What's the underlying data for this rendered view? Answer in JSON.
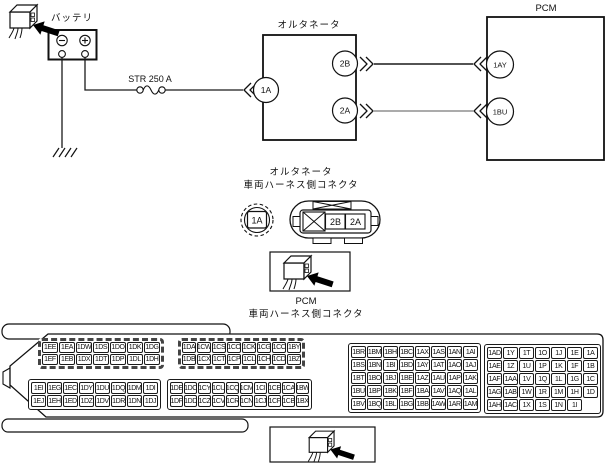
{
  "top_diagram": {
    "battery": {
      "label": "バッテリ",
      "minus_symbol": "−",
      "plus_symbol": "+"
    },
    "fuse": {
      "label": "STR 250 A"
    },
    "alternator": {
      "label": "オルタネータ",
      "pin_1a": "1A",
      "pin_2b": "2B",
      "pin_2a": "2A"
    },
    "pcm": {
      "label": "PCM",
      "pin_1ay": "1AY",
      "pin_1bu": "1BU"
    },
    "wire_colors": {
      "black_wire": "#1a1a1a",
      "gray_wire": "#8f8f8f"
    }
  },
  "alt_connector": {
    "title_line1": "オルタネータ",
    "title_line2": "車両ハーネス側コネクタ",
    "round_pin": "1A",
    "oval_pins": [
      "2B",
      "2A"
    ]
  },
  "pcm_connector": {
    "title_line1": "PCM",
    "title_line2": "車両ハーネス側コネクタ",
    "blocks": {
      "b1_top": [
        [
          "1EE",
          "1EA",
          "1DW",
          "1DS",
          "1DO",
          "1DK",
          "1DG"
        ],
        [
          "1EF",
          "1EB",
          "1DX",
          "1DT",
          "1DP",
          "1DL",
          "1DH"
        ]
      ],
      "b1_bottom": [
        [
          "1EI",
          "1EG",
          "1EC",
          "1DY",
          "1DU",
          "1DQ",
          "1DM",
          "1DI"
        ],
        [
          "1EJ",
          "1EH",
          "1ED",
          "1DZ",
          "1DV",
          "1DR",
          "1DN",
          "1DJ"
        ]
      ],
      "b2_top": [
        [
          "1DA",
          "1CW",
          "1CS",
          "1CO",
          "1CK",
          "1CG",
          "1CC",
          "1BY"
        ],
        [
          "1DB",
          "1CX",
          "1CT",
          "1CP",
          "1CL",
          "1CH",
          "1CD",
          "1BZ"
        ]
      ],
      "b2_bottom": [
        [
          "1DE",
          "1DC",
          "1CY",
          "1CU",
          "1CQ",
          "1CM",
          "1CI",
          "1CE",
          "1CA",
          "1BW"
        ],
        [
          "1DF",
          "1DD",
          "1CZ",
          "1CV",
          "1CR",
          "1CN",
          "1CJ",
          "1CF",
          "1CB",
          "1BX"
        ]
      ],
      "b3": [
        [
          "1BR",
          "1BM",
          "1BH",
          "1BC",
          "1AX",
          "1AS",
          "1AN",
          "1AI"
        ],
        [
          "1BS",
          "1BN",
          "1BI",
          "1BD",
          "1AY",
          "1AT",
          "1AO",
          "1AJ"
        ],
        [
          "1BT",
          "1BO",
          "1BJ",
          "1BE",
          "1AZ",
          "1AU",
          "1AP",
          "1AK"
        ],
        [
          "1BU",
          "1BP",
          "1BK",
          "1BF",
          "1BA",
          "1AV",
          "1AQ",
          "1AL"
        ],
        [
          "1BV",
          "1BQ",
          "1BL",
          "1BG",
          "1BB",
          "1AW",
          "1AR",
          "1AM"
        ]
      ],
      "b4": [
        [
          "1AD",
          "1Y",
          "1T",
          "1O",
          "1J",
          "1E",
          "1A"
        ],
        [
          "1AE",
          "1Z",
          "1U",
          "1P",
          "1K",
          "1F",
          "1B"
        ],
        [
          "1AF",
          "1AA",
          "1V",
          "1Q",
          "1L",
          "1G",
          "1C"
        ],
        [
          "1AG",
          "1AB",
          "1W",
          "1R",
          "1M",
          "1H",
          "1D"
        ],
        [
          "1AH",
          "1AC",
          "1X",
          "1S",
          "1N",
          "1I"
        ]
      ]
    }
  }
}
